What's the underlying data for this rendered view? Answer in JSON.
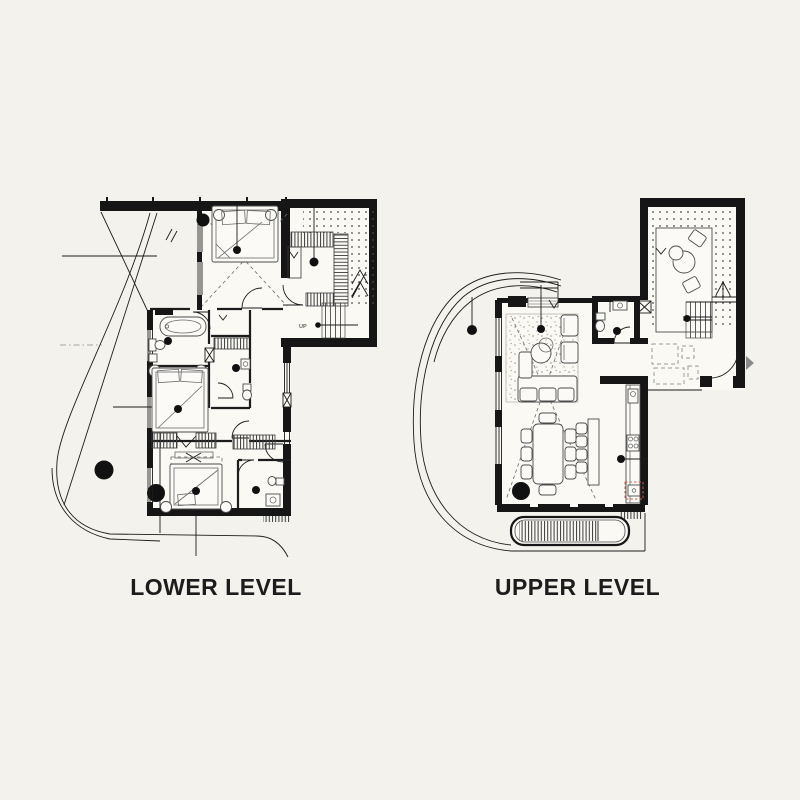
{
  "page": {
    "type": "architectural-floor-plans"
  },
  "colors": {
    "background": "#f4f2ec",
    "paper": "#faf9f4",
    "ink": "#1c1c1c",
    "line": "#3a3a3a",
    "muted": "#8a8a8a",
    "accent-red": "#c9685c"
  },
  "plans": {
    "lower": {
      "label": "LOWER LEVEL",
      "stair_label": "UP"
    },
    "upper": {
      "label": "UPPER LEVEL"
    }
  }
}
